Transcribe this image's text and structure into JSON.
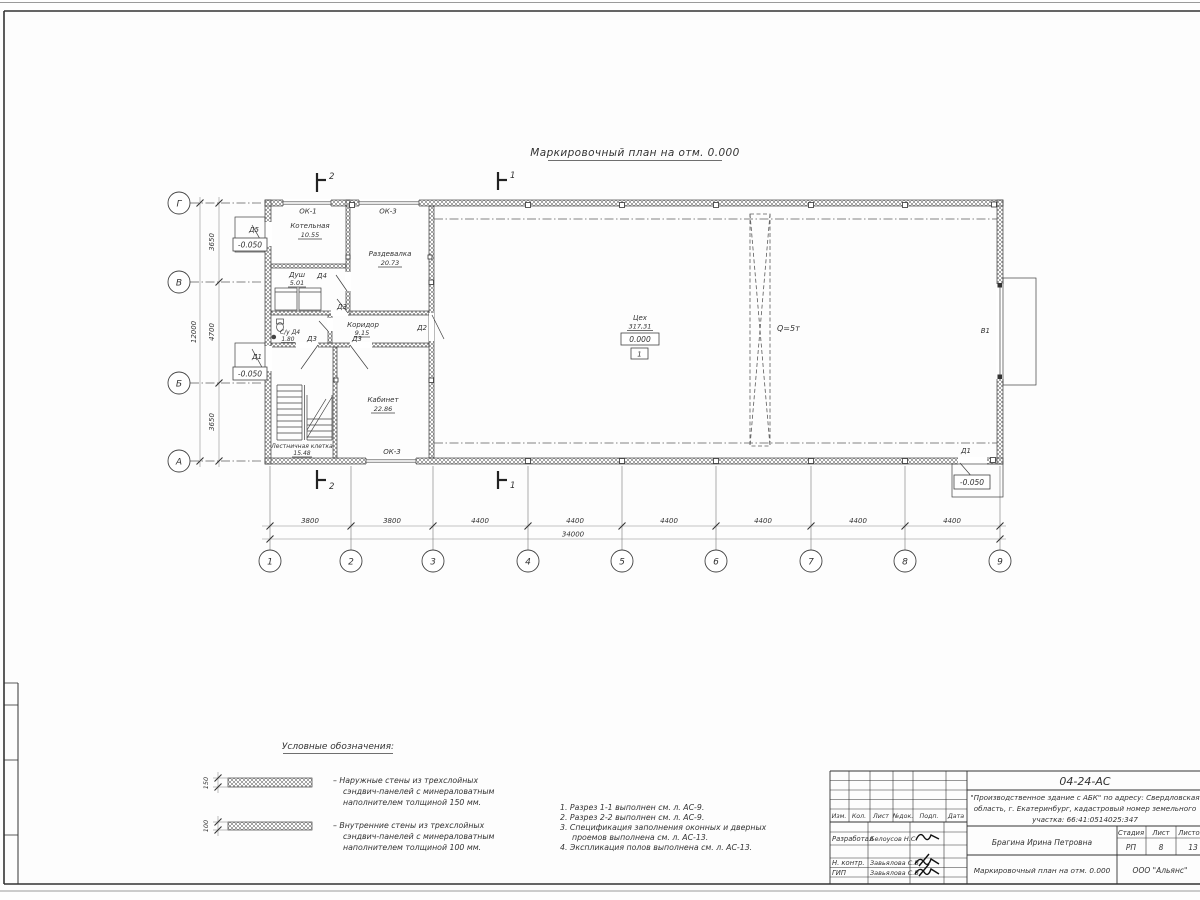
{
  "sheet": {
    "plan_title": "Маркировочный план на отм. 0.000"
  },
  "axes": {
    "cols": [
      "1",
      "2",
      "3",
      "4",
      "5",
      "6",
      "7",
      "8",
      "9"
    ],
    "rows": [
      "Г",
      "В",
      "Б",
      "А"
    ]
  },
  "dims": {
    "col_segments": [
      "3800",
      "3800",
      "4400",
      "4400",
      "4400",
      "4400",
      "4400",
      "4400"
    ],
    "col_total": "34000",
    "row_segments": [
      "3650",
      "4700",
      "3650"
    ],
    "row_total": "12000"
  },
  "rooms": {
    "kotelnaya": {
      "name": "Котельная",
      "area": "10.55"
    },
    "razdevalka": {
      "name": "Раздевалка",
      "area": "20.73"
    },
    "dush": {
      "name": "Душ",
      "area": "5.01"
    },
    "su": {
      "name": "С/у Д4",
      "area": "1.80"
    },
    "koridor": {
      "name": "Коридор",
      "area": "9.15"
    },
    "kabinet": {
      "name": "Кабинет",
      "area": "22.86"
    },
    "lestnichnaya": {
      "name": "Лестничная клетка",
      "area": "15.48"
    },
    "tseh": {
      "name": "Цех",
      "area": "317,31"
    }
  },
  "marks": {
    "level_zero": "0.000",
    "level_minus": "-0.050",
    "tseh_number": "1",
    "crane_capacity": "Q=5т",
    "gate": "В1",
    "doors": {
      "d1": "Д1",
      "d2": "Д2",
      "d3": "Д3",
      "d4": "Д4",
      "d5": "Д5"
    },
    "windows": {
      "ok1": "ОК-1",
      "ok3": "ОК-3"
    },
    "sections": {
      "s1": "1",
      "s2": "2"
    }
  },
  "legend": {
    "title": "Условные обозначения:",
    "items": [
      {
        "thickness": "150",
        "lines": [
          "–  Наружные стены из трехслойных",
          "сэндвич-панелей с минераловатным",
          "наполнителем толщиной 150 мм."
        ]
      },
      {
        "thickness": "100",
        "lines": [
          "–  Внутренние стены из трехслойных",
          "сэндвич-панелей с минераловатным",
          "наполнителем толщиной 100 мм."
        ]
      }
    ]
  },
  "notes": [
    "1. Разрез 1-1 выполнен см. л. АС-9.",
    "2. Разрез 2-2 выполнен см. л. АС-9.",
    "3. Спецификация заполнения оконных и дверных",
    "проемов выполнена см. л. АС-13.",
    "4. Экспликация полов выполнена см. л. АС-13."
  ],
  "titleblock": {
    "code": "04-24-АС",
    "project_lines": [
      "\"Производственное здание с АБК\" по адресу: Свердловская",
      "область, г. Екатеринбург, кадастровый номер земельного",
      "участка: 66:41:0514025:347"
    ],
    "columns": {
      "izm": "Изм.",
      "kol": "Кол.",
      "list": "Лист",
      "ndok": "№док.",
      "podp": "Подп.",
      "data": "Дата"
    },
    "stage_header": {
      "stage": "Стадия",
      "sheet": "Лист",
      "sheets": "Листов"
    },
    "stage": "РП",
    "sheet": "8",
    "sheets": "13",
    "rows": {
      "razrabotal": {
        "role": "Разработал",
        "name": "Белоусов Н.С."
      },
      "nkontr": {
        "role": "Н. контр.",
        "name": "Завьялова С.В"
      },
      "gip": {
        "role": "ГИП",
        "name": "Завьялова С.В"
      }
    },
    "author": "Брагина Ирина Петровна",
    "doc_title": "Маркировочный план на отм. 0.000",
    "company": "ООО \"Альянс\""
  }
}
